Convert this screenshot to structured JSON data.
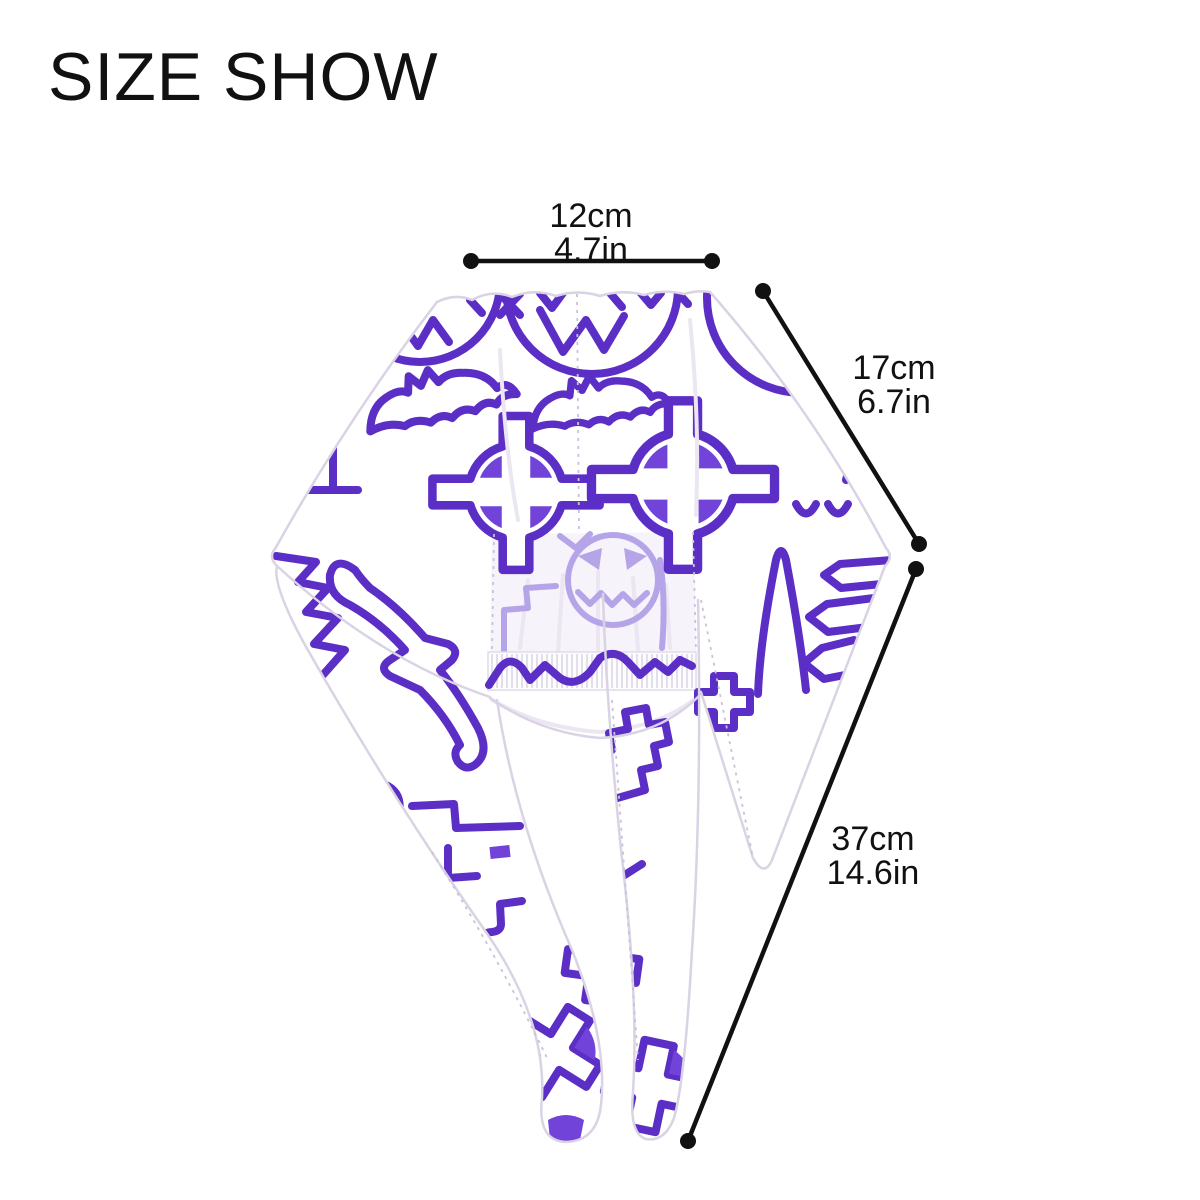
{
  "page": {
    "background": "#ffffff"
  },
  "header": {
    "title": "SIZE SHOW"
  },
  "measurements": {
    "top_width": {
      "cm": "12cm",
      "inch": "4.7in"
    },
    "side_depth": {
      "cm": "17cm",
      "inch": "6.7in"
    },
    "tail_length": {
      "cm": "37cm",
      "inch": "14.6in"
    }
  },
  "product": {
    "type": "scrub-cap-head-wrap-back-view",
    "pattern": "halloween-outline-print",
    "motifs": [
      "jack-o-lantern",
      "bat",
      "celtic-cross-goggles",
      "pine-tree",
      "castle",
      "tombstone-cross",
      "ghost-face"
    ],
    "colors": {
      "pattern_purple": "#5b2ec6",
      "pattern_purple_fill": "#7243d8",
      "pattern_purple_faded": "#b5a5e8",
      "fabric_white": "#ffffff",
      "annotation_black": "#111111"
    }
  }
}
